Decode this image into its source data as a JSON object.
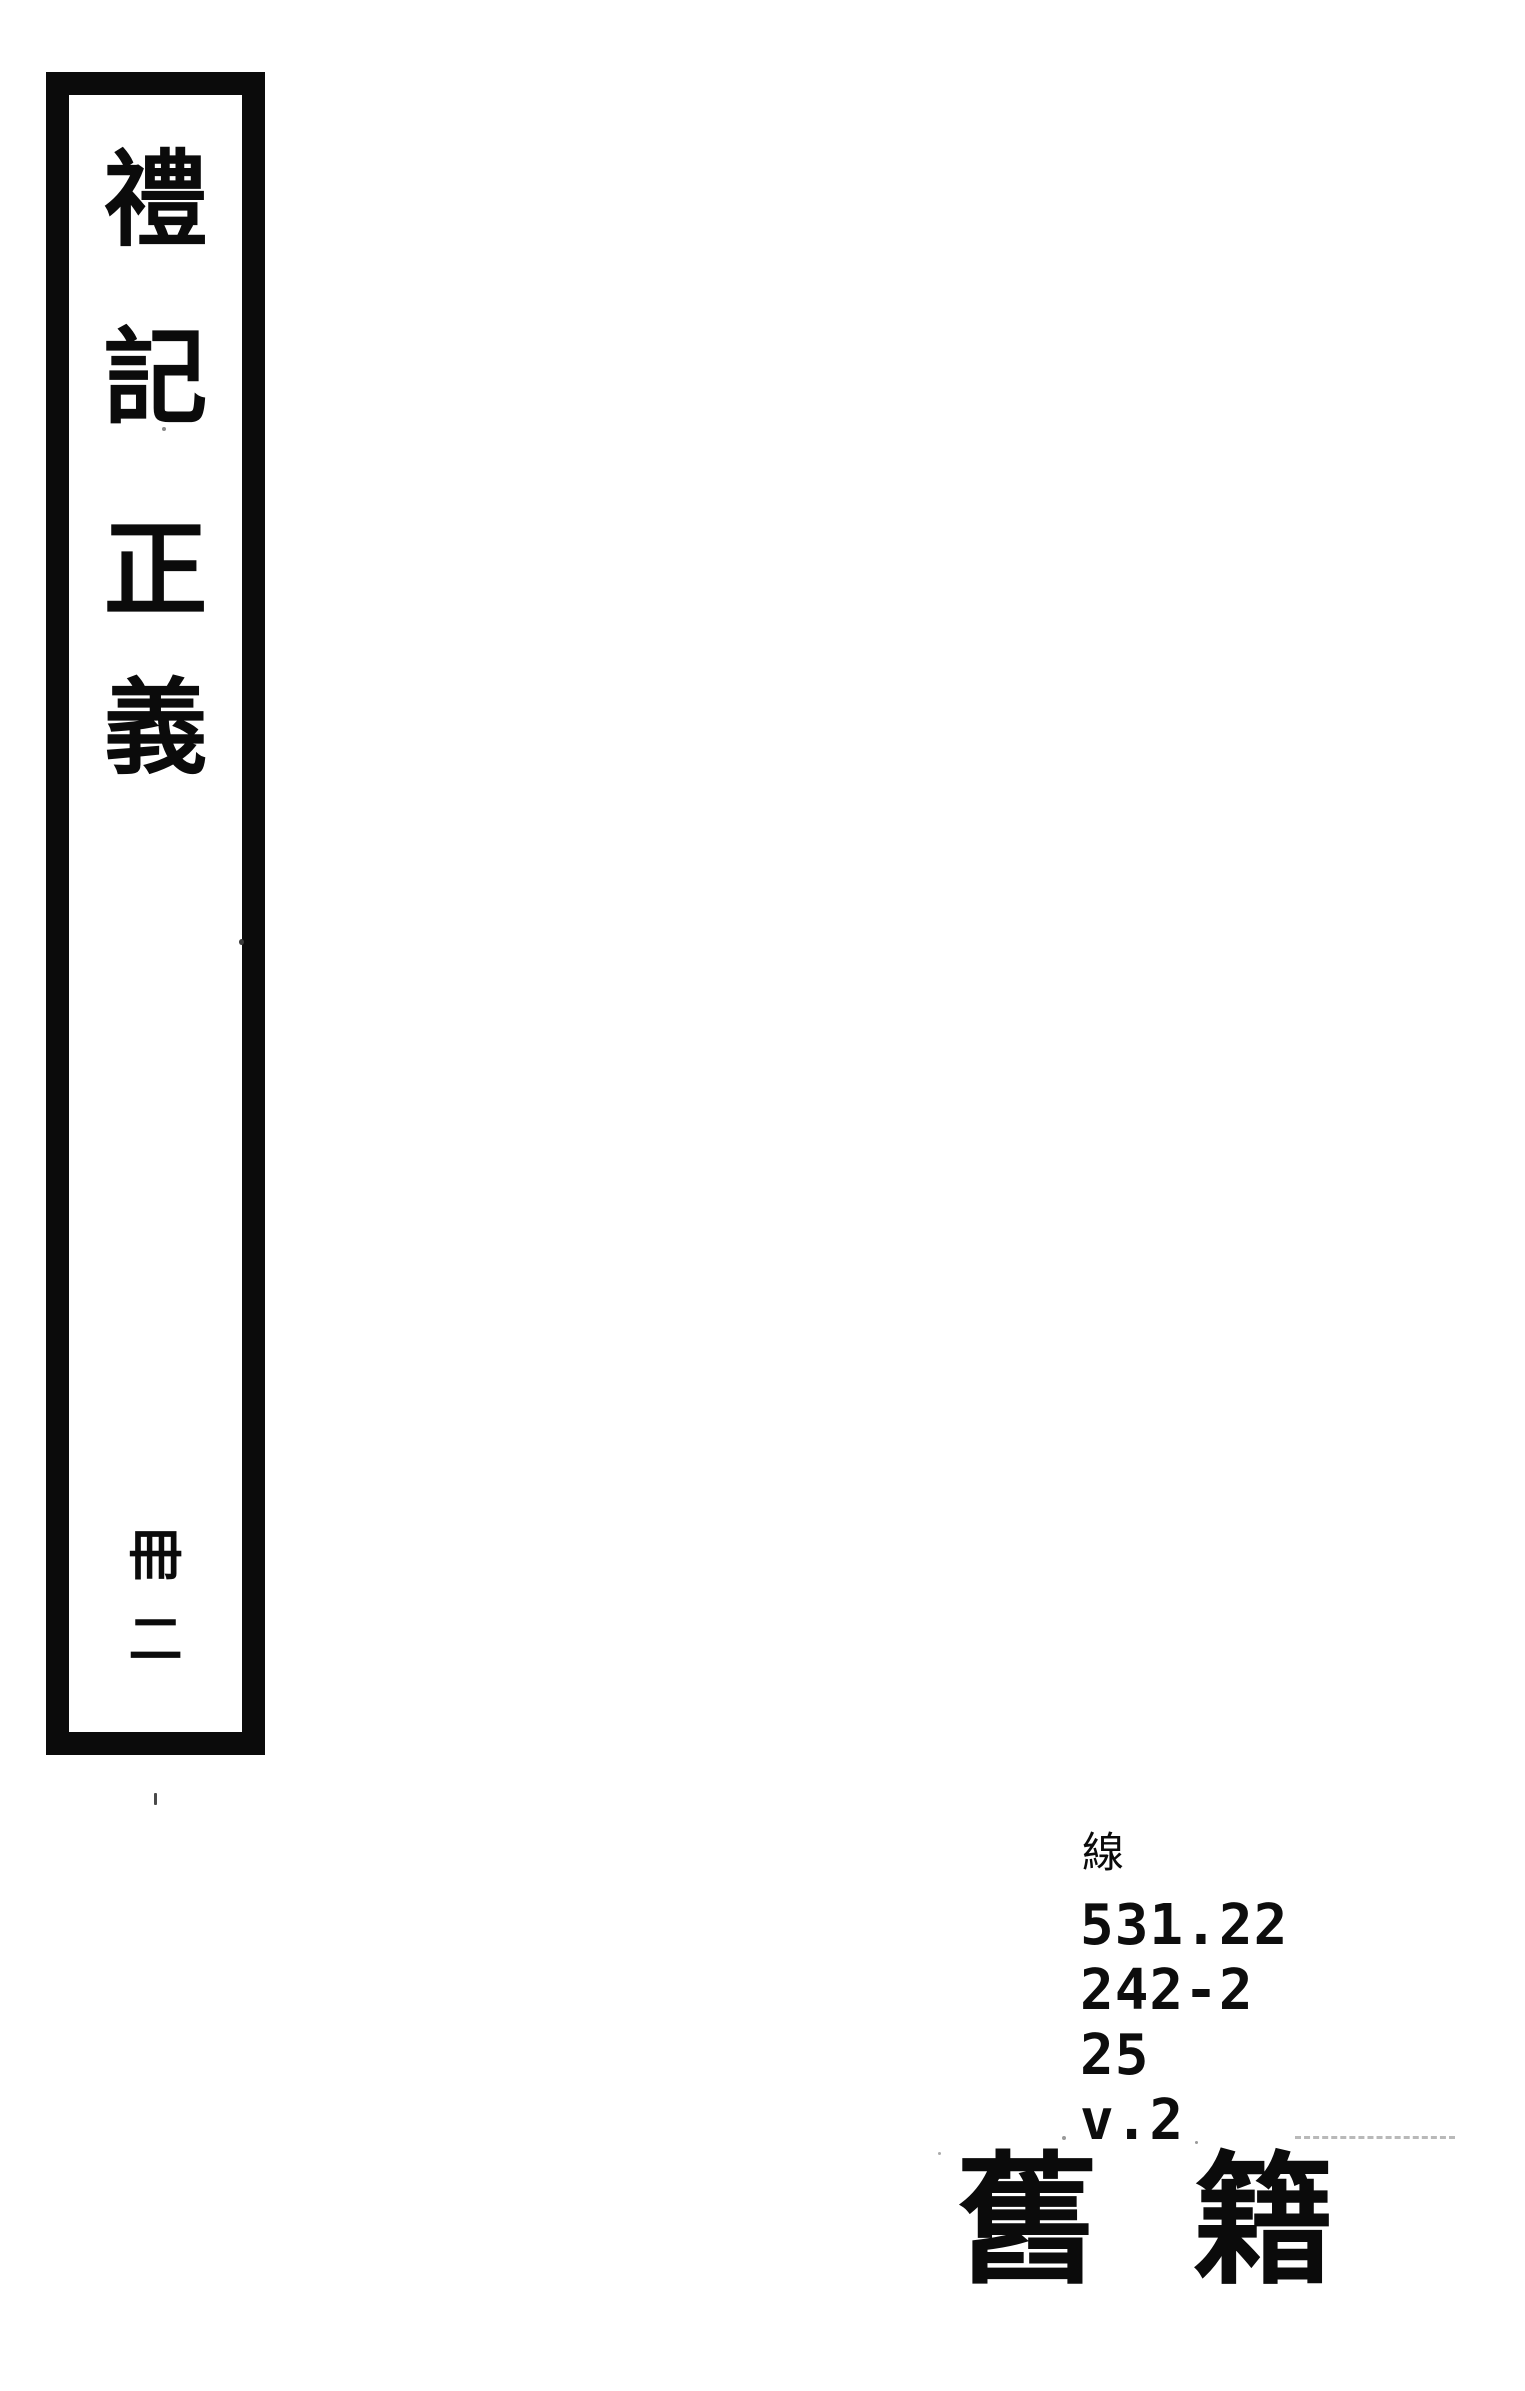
{
  "spine": {
    "title": "禮記正義",
    "title_chars": [
      "禮",
      "記",
      "正",
      "義"
    ],
    "volume": "冊二",
    "volume_chars": [
      "冊",
      "二"
    ]
  },
  "call_number": {
    "script_label": "線",
    "lines": [
      "531.22",
      "242-2",
      "25",
      "v.2"
    ]
  },
  "category_label": {
    "text": "舊籍",
    "chars": [
      "舊",
      "籍"
    ]
  },
  "colors": {
    "ink": "#0b0b0b",
    "paper": "#ffffff"
  }
}
